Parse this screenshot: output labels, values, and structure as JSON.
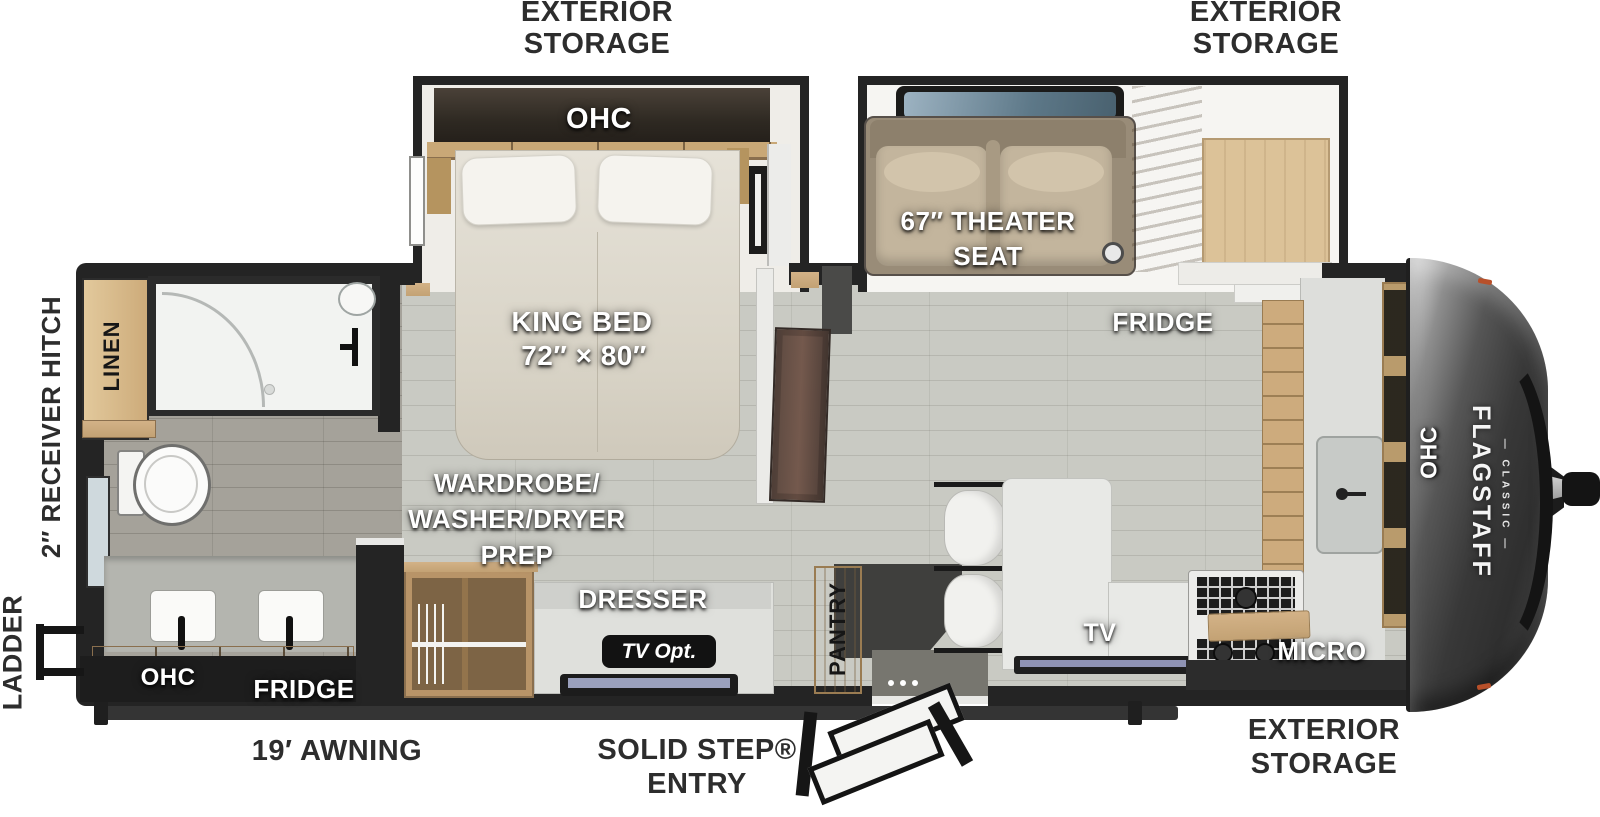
{
  "page": {
    "title": "Flagstaff Classic Travel Trailer — Floor Plan"
  },
  "brand": {
    "name": "FLAGSTAFF",
    "series": "— CLASSIC —"
  },
  "exterior": {
    "storage": {
      "line1": "EXTERIOR",
      "line2": "STORAGE"
    },
    "awning": "19′ AWNING",
    "entry": {
      "line1": "SOLID STEP®",
      "line2": "ENTRY"
    },
    "ladder": "LADDER",
    "receiver_hitch": "2″ RECEIVER HITCH"
  },
  "bedroom": {
    "ohc": "OHC",
    "bed": {
      "line1": "KING BED",
      "line2": "72″ × 80″"
    },
    "wardrobe": {
      "line1": "WARDROBE/",
      "line2": "WASHER/DRYER",
      "line3": "PREP"
    },
    "dresser": "DRESSER",
    "tv_option": "TV Opt."
  },
  "bathroom": {
    "linen": "LINEN",
    "ohc": "OHC",
    "fridge": "FRIDGE"
  },
  "living": {
    "theater_seat": {
      "line1": "67″ THEATER",
      "line2": "SEAT"
    },
    "fridge": "FRIDGE",
    "pantry": "PANTRY",
    "tv": "TV"
  },
  "kitchen": {
    "ohc": "OHC",
    "micro": "MICRO"
  },
  "colors": {
    "wall": "#242424",
    "floor_main": "#c9cac3",
    "floor_bath": "#a5a29a",
    "wood": "#cfab7c",
    "front_cap": "#3d3d3d",
    "label_on_floor": "#ffffff",
    "label_exterior": "#2d2d2d"
  }
}
